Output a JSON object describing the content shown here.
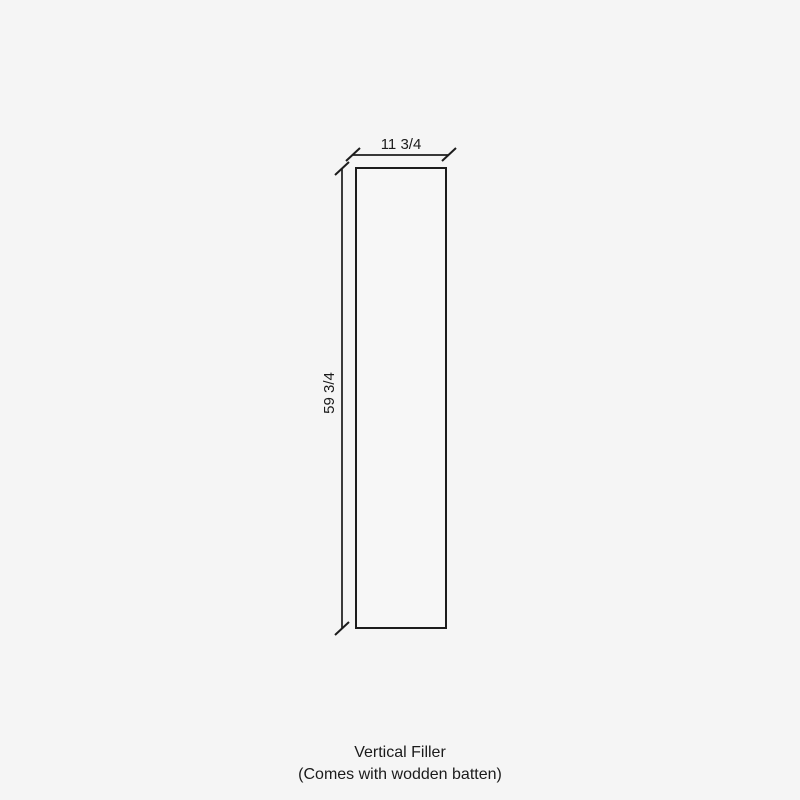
{
  "drawing": {
    "kind": "dimensioned-panel-outline",
    "width_label": "11 3/4",
    "height_label": "59 3/4"
  },
  "caption": {
    "line1": "Vertical Filler",
    "line2": "(Comes with wodden batten)"
  },
  "colors": {
    "background": "#f5f5f5",
    "line": "#1c1c1c",
    "text": "#1b1b1b",
    "panel_fill": "#f7f7f7"
  }
}
